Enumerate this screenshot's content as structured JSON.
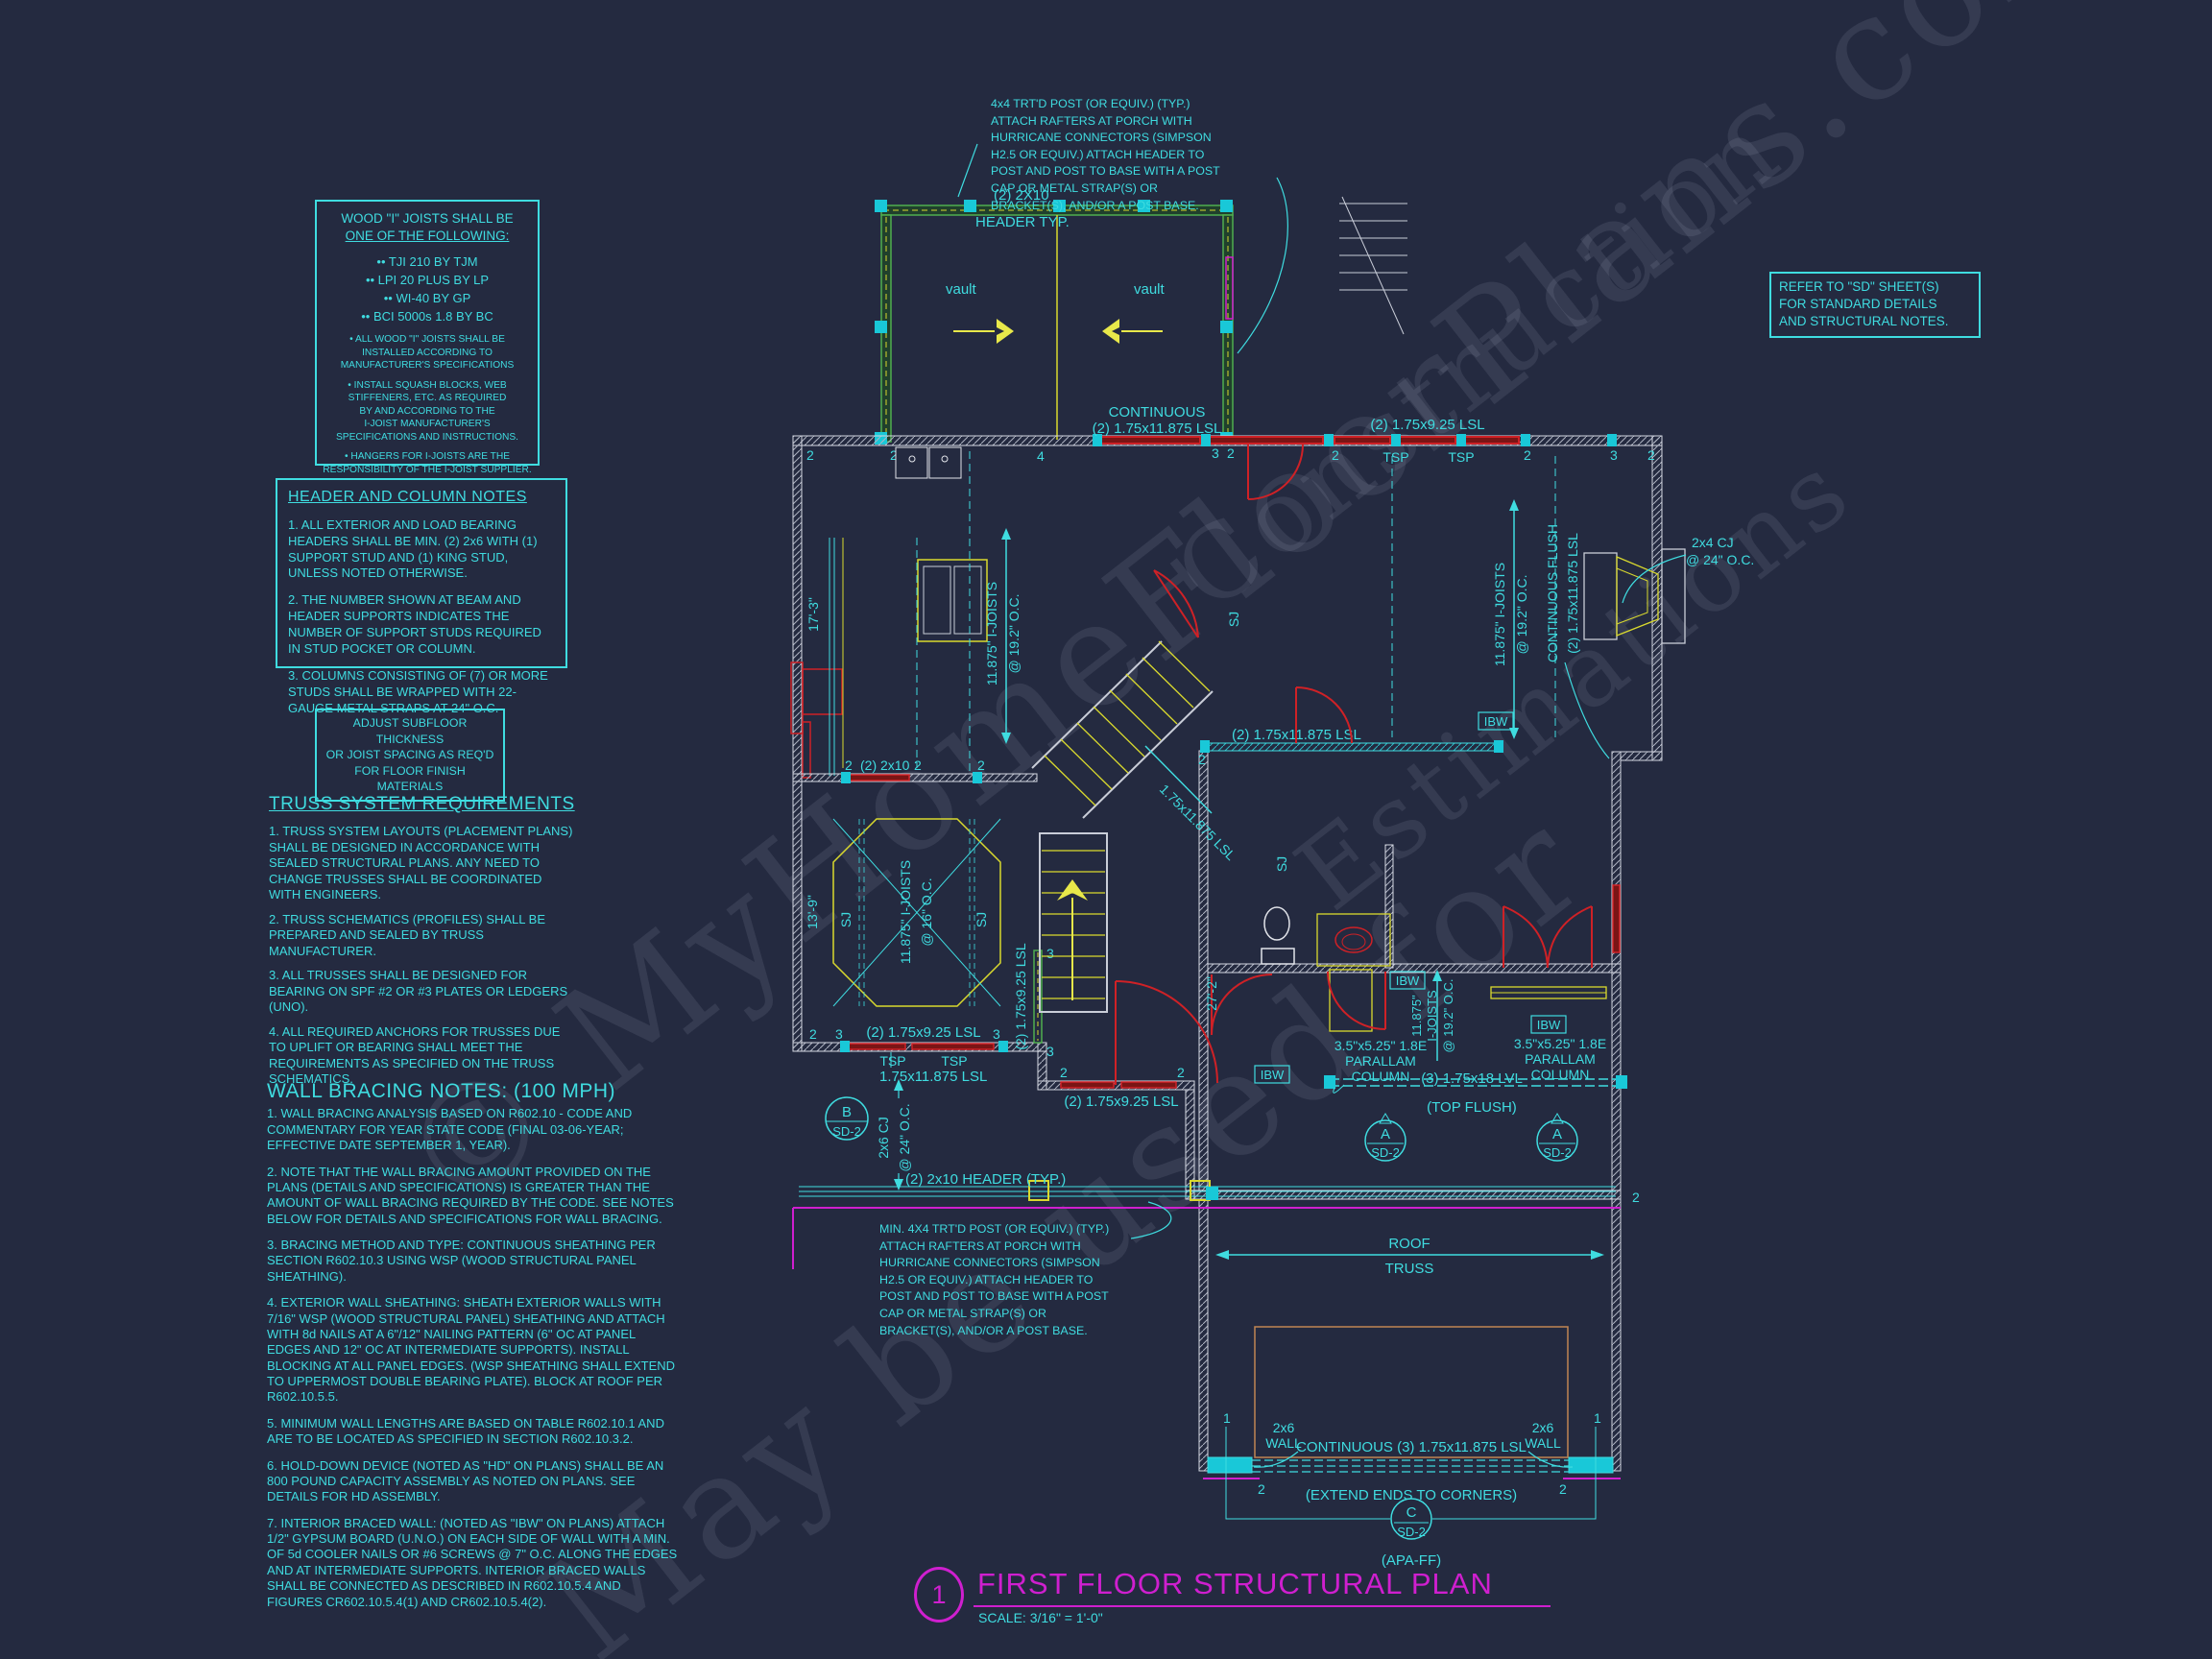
{
  "colors": {
    "bg": "#242a40",
    "cyan": "#3fdce0",
    "yellow": "#d9d92e",
    "green": "#4fae4f",
    "red": "#cf2126",
    "magenta": "#cf1fcf",
    "wall": "#d5d8e2",
    "tan": "#c08552",
    "watermark": "#9aa0b5"
  },
  "watermark": {
    "l1": "© MyHomeFloorPlans.com",
    "l2": "Construction",
    "l3": "Estimations",
    "l4": "May be used for"
  },
  "notes": {
    "wood": {
      "line1": "WOOD \"I\" JOISTS SHALL BE",
      "line2": "ONE OF THE FOLLOWING:",
      "bullets": "•• TJI 210 BY TJM\n•• LPI 20 PLUS BY LP\n•• WI-40 BY GP\n•• BCI 5000s 1.8 BY BC",
      "sub1": "• ALL WOOD \"I\" JOISTS SHALL BE\nINSTALLED ACCORDING TO\nMANUFACTURER'S SPECIFICATIONS",
      "sub2": "• INSTALL SQUASH BLOCKS, WEB\nSTIFFENERS, ETC. AS REQUIRED\nBY AND ACCORDING TO THE\nI-JOIST MANUFACTURER'S\nSPECIFICATIONS AND INSTRUCTIONS.",
      "sub3": "• HANGERS FOR I-JOISTS ARE THE\nRESPONSIBILITY OF THE I-JOIST SUPPLIER."
    },
    "hcn": {
      "title": "HEADER AND COLUMN NOTES",
      "p1": "1. ALL EXTERIOR AND LOAD BEARING HEADERS SHALL BE MIN. (2) 2x6 WITH (1) SUPPORT STUD AND (1) KING STUD, UNLESS NOTED OTHERWISE.",
      "p2": "2. THE NUMBER SHOWN AT BEAM AND HEADER SUPPORTS INDICATES THE NUMBER OF SUPPORT STUDS REQUIRED IN STUD POCKET OR COLUMN.",
      "p3": "3. COLUMNS CONSISTING OF (7) OR MORE STUDS SHALL BE WRAPPED WITH 22-GAUGE METAL STRAPS AT 24\" O.C."
    },
    "subfloor": "ADJUST SUBFLOOR THICKNESS\nOR JOIST SPACING AS REQ'D\nFOR FLOOR FINISH MATERIALS",
    "truss": {
      "title": "TRUSS SYSTEM REQUIREMENTS",
      "p1": "1. TRUSS SYSTEM LAYOUTS (PLACEMENT PLANS) SHALL BE DESIGNED IN ACCORDANCE WITH SEALED STRUCTURAL PLANS. ANY NEED TO CHANGE TRUSSES SHALL BE COORDINATED WITH  ENGINEERS.",
      "p2": "2. TRUSS SCHEMATICS (PROFILES) SHALL BE PREPARED AND SEALED BY TRUSS MANUFACTURER.",
      "p3": "3. ALL TRUSSES SHALL BE DESIGNED FOR BEARING ON SPF #2 OR #3 PLATES OR LEDGERS (UNO).",
      "p4": "4. ALL REQUIRED ANCHORS FOR TRUSSES DUE TO UPLIFT OR BEARING SHALL MEET THE REQUIREMENTS AS SPECIFIED ON THE TRUSS SCHEMATICS."
    },
    "wbn": {
      "title": "WALL BRACING NOTES: (100 MPH)",
      "p1": "1. WALL BRACING ANALYSIS BASED ON R602.10 - CODE AND COMMENTARY FOR YEAR STATE CODE (FINAL 03-06-YEAR; EFFECTIVE DATE SEPTEMBER 1, YEAR).",
      "p2": "2. NOTE THAT THE WALL BRACING AMOUNT PROVIDED ON THE PLANS (DETAILS AND SPECIFICATIONS) IS GREATER THAN THE AMOUNT OF WALL BRACING REQUIRED BY THE CODE. SEE NOTES BELOW FOR DETAILS AND SPECIFICATIONS FOR WALL BRACING.",
      "p3": "3. BRACING METHOD AND TYPE: CONTINUOUS SHEATHING PER SECTION R602.10.3 USING WSP (WOOD STRUCTURAL PANEL SHEATHING).",
      "p4": "4. EXTERIOR WALL SHEATHING: SHEATH EXTERIOR WALLS WITH 7/16\" WSP (WOOD STRUCTURAL PANEL) SHEATHING AND ATTACH WITH 8d NAILS AT A 6\"/12\" NAILING PATTERN (6\" OC AT PANEL EDGES AND 12\" OC AT INTERMEDIATE SUPPORTS). INSTALL BLOCKING AT ALL PANEL EDGES. (WSP SHEATHING SHALL EXTEND TO UPPERMOST DOUBLE BEARING PLATE). BLOCK AT ROOF PER R602.10.5.5.",
      "p5": "5. MINIMUM WALL LENGTHS ARE BASED ON TABLE R602.10.1 AND ARE TO BE LOCATED AS SPECIFIED IN SECTION R602.10.3.2.",
      "p6": "6. HOLD-DOWN DEVICE (NOTED AS \"HD\" ON PLANS) SHALL BE AN 800 POUND CAPACITY ASSEMBLY AS NOTED ON PLANS. SEE DETAILS FOR HD ASSEMBLY.",
      "p7": "7. INTERIOR BRACED WALL: (NOTED AS \"IBW\" ON PLANS) ATTACH 1/2\" GYPSUM BOARD (U.N.O.) ON EACH SIDE OF WALL WITH A MIN. OF 5d COOLER NAILS OR #6 SCREWS @ 7\" O.C. ALONG THE EDGES AND AT INTERMEDIATE SUPPORTS.  INTERIOR BRACED WALLS SHALL BE CONNECTED AS DESCRIBED IN R602.10.5.4 AND FIGURES CR602.10.5.4(1) AND CR602.10.5.4(2)."
    },
    "post_top": "4x4 TRT'D POST (OR EQUIV.) (TYP.)\nATTACH RAFTERS AT PORCH WITH\nHURRICANE CONNECTORS (SIMPSON\nH2.5 OR EQUIV.) ATTACH HEADER TO\nPOST AND POST TO BASE WITH A POST\nCAP OR METAL STRAP(S) OR\nBRACKET(S), AND/OR A POST BASE.",
    "post_bot": "MIN. 4X4 TRT'D POST (OR EQUIV.) (TYP.)\nATTACH RAFTERS AT PORCH WITH\nHURRICANE CONNECTORS (SIMPSON\nH2.5 OR EQUIV.) ATTACH HEADER TO\nPOST AND POST TO BASE WITH A POST\nCAP OR METAL STRAP(S) OR\nBRACKET(S), AND/OR A POST BASE.",
    "sd": "REFER TO \"SD\" SHEET(S)\nFOR STANDARD DETAILS\nAND STRUCTURAL NOTES."
  },
  "plan": {
    "header_2x10": "(2) 2X10",
    "header_typ": "HEADER TYP.",
    "vault": "vault",
    "continuous": "CONTINUOUS",
    "lsl_11875_2x": "(2) 1.75x11.875 LSL",
    "lsl_925_2x": "(2) 1.75x9.25 LSL",
    "lsl_11875": "1.75x11.875 LSL",
    "tsp": "TSP",
    "joist_l1": "11.875\" I-JOISTS",
    "joist_192": "@ 19.2\" O.C.",
    "joist_16": "@ 16\" O.C.",
    "joist_depth": "11.875\"",
    "joist_word": "I-JOISTS",
    "sj": "SJ",
    "dim_17_3": "17'-3\"",
    "dim_13_9": "13'-9\"",
    "dim_27_2": "27'-2\"",
    "cj24_l1": "2x4 CJ",
    "cj24_l2": "@ 24\" O.C.",
    "cj26_l1": "2x6 CJ",
    "cont_flush": "CONTINUOUS FLUSH",
    "ibw": "IBW",
    "par_l1": "3.5\"x5.25\" 1.8E",
    "par_l2": "PARALLAM",
    "par_l3": "COLUMN",
    "lvl18": "(3) 1.75x18 LVL",
    "top_flush": "(TOP FLUSH)",
    "roof": "ROOF",
    "truss": "TRUSS",
    "w26_l1": "2x6",
    "w26_l2": "WALL",
    "cont3": "CONTINUOUS (3) 1.75x11.875 LSL",
    "extend": "(EXTEND ENDS TO CORNERS)",
    "apa": "(APA-FF)",
    "hdr_typ_b": "(2) 2x10 HEADER (TYP.)",
    "hdr_2x10_b": "(2) 2x10",
    "ca": "A",
    "cb": "B",
    "cc": "C",
    "sd2": "SD-2",
    "n1": "1",
    "n2": "2",
    "n3": "3",
    "n4": "4"
  },
  "title_block": {
    "num": "1",
    "title": "FIRST FLOOR STRUCTURAL PLAN",
    "scale": "SCALE: 3/16\" = 1'-0\""
  }
}
